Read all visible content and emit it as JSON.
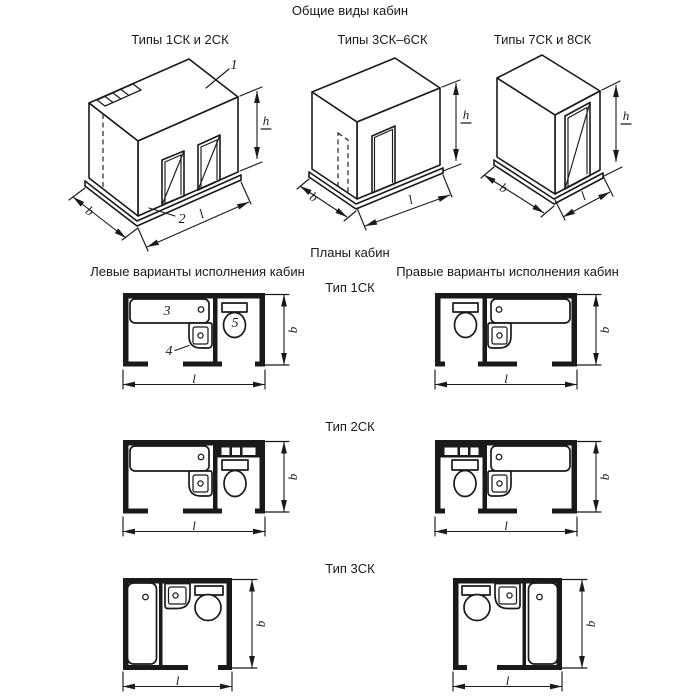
{
  "page": {
    "background": "#ffffff",
    "ink": "#1a1a1a"
  },
  "general_views": {
    "title": "Общие виды кабин",
    "figures": [
      {
        "caption": "Типы 1СК и 2СК"
      },
      {
        "caption": "Типы 3СК–6СК"
      },
      {
        "caption": "Типы 7СК и 8СК"
      }
    ]
  },
  "plans": {
    "title": "Планы кабин",
    "left_header": "Левые варианты исполнения кабин",
    "right_header": "Правые варианты исполнения кабин",
    "rows": [
      {
        "label": "Тип 1СК"
      },
      {
        "label": "Тип 2СК"
      },
      {
        "label": "Тип 3СК"
      }
    ]
  },
  "dims": {
    "b": "b",
    "l": "l",
    "h": "h"
  },
  "callouts": {
    "c1": "1",
    "c2": "2",
    "c3": "3",
    "c4": "4",
    "c5": "5"
  }
}
